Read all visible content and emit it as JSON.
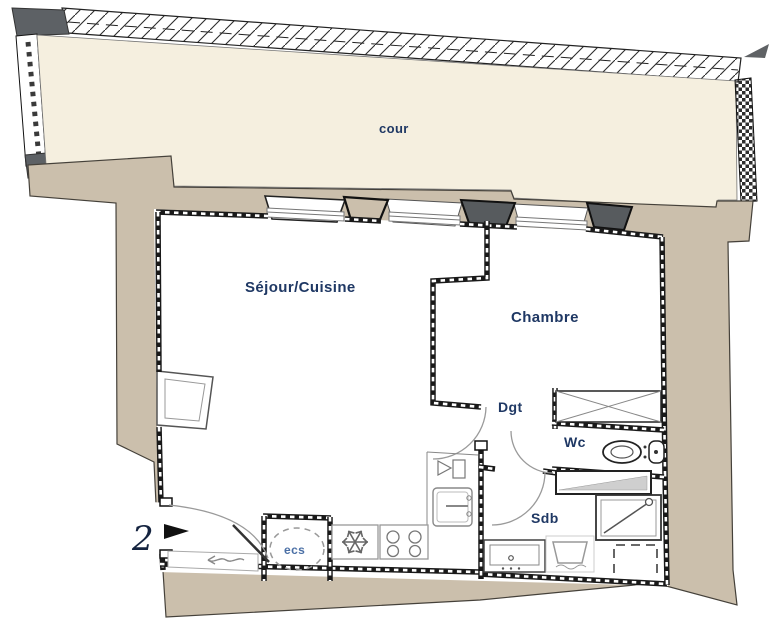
{
  "floorplan": {
    "labels": {
      "courtyard": "cour",
      "living_kitchen": "Séjour/Cuisine",
      "bedroom": "Chambre",
      "hallway": "Dgt",
      "toilet": "Wc",
      "bathroom": "Sdb",
      "water_heater": "ecs",
      "entrance_number": "2"
    },
    "colors": {
      "courtyard_fill": "#f5efdf",
      "wall_fill": "#cbbfac",
      "dark_masonry": "#5d6165",
      "room_label": "#1f3864",
      "water_heater_label": "#4a6fa5",
      "wall_line": "#191919"
    },
    "icons": [
      "hatched-party-wall-icon",
      "checker-wall-icon",
      "snowflake-icon",
      "stove-burners-icon",
      "kitchen-sink-icon",
      "dish-rack-icon",
      "toilet-icon",
      "shower-icon",
      "washing-machine-icon",
      "washbasin-icon",
      "closet-cross-icon",
      "water-heater-dashed-circle",
      "door-swing-arc",
      "entrance-arrow-icon",
      "storage-arrow-icon"
    ]
  }
}
